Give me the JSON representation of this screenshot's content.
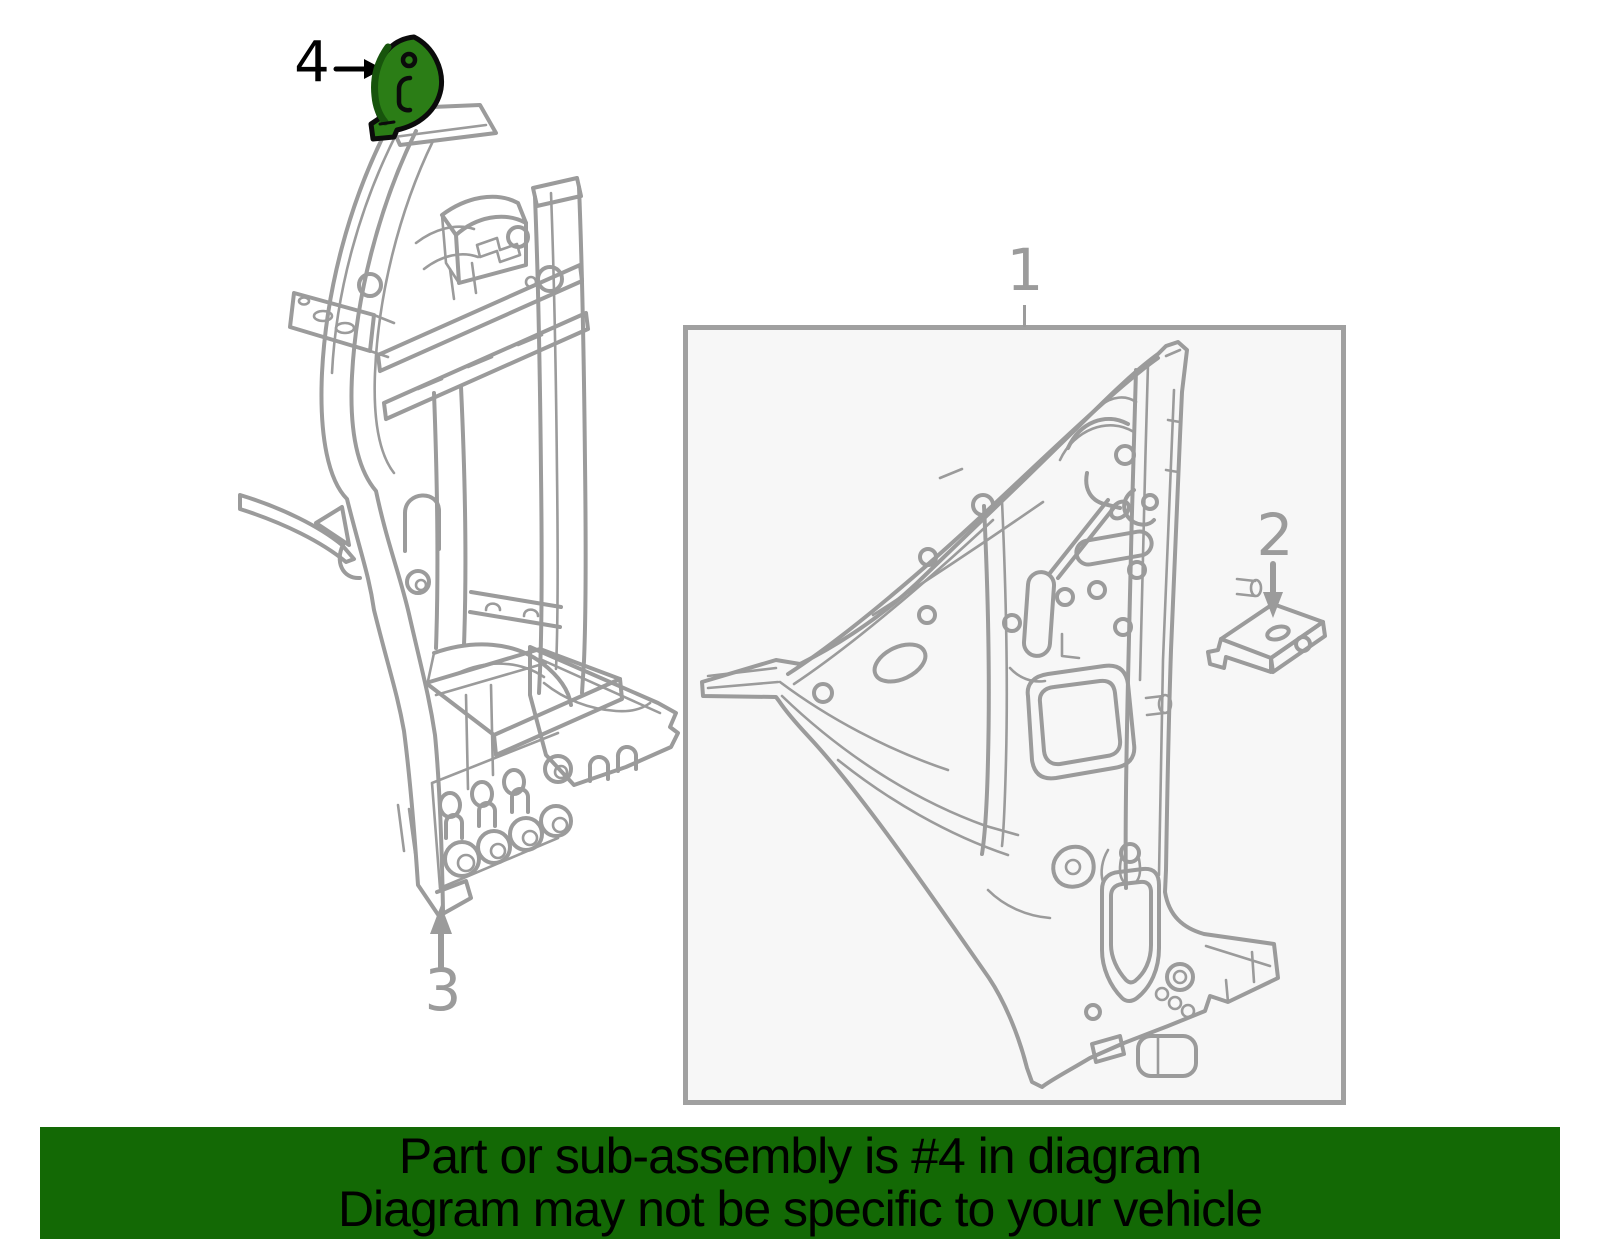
{
  "callouts": {
    "one": "1",
    "two": "2",
    "three": "3",
    "four": "4"
  },
  "banner": {
    "line1": "Part or sub-assembly is #4 in diagram",
    "line2": "Diagram may not be specific to your vehicle"
  },
  "colors": {
    "page_background": "#ffffff",
    "diagram_line_gray": "#9b9b9b",
    "label_gray": "#9b9b9b",
    "label_black": "#000000",
    "box_border": "#a0a0a0",
    "box_background": "#f7f7f7",
    "banner_background": "#136905",
    "banner_text": "#000000",
    "highlight_fill": "#2b7d16",
    "highlight_edge": "#17540c",
    "highlight_outline": "#0b0b0b"
  }
}
